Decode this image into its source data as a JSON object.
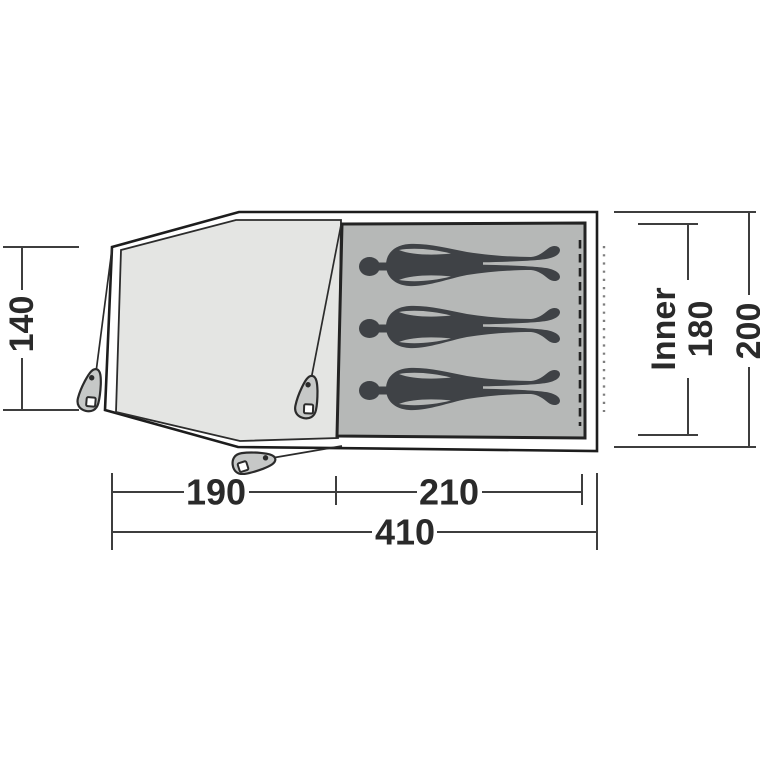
{
  "diagram": {
    "title": "tent-floorplan-top-view",
    "dimensions": {
      "porch_depth": "140",
      "porch_width": "190",
      "inner_length": "210",
      "total_width": "410",
      "inner_label": "Inner",
      "inner_width": "180",
      "total_depth": "200"
    },
    "occupants": {
      "count": 3,
      "icon": "sleeping-person-silhouette"
    },
    "colors": {
      "background": "#ffffff",
      "outline": "#1d1d1d",
      "porch_fill": "#e4e5e3",
      "inner_fill": "#b6b8b7",
      "figure_fill": "#3f4246",
      "peg_fill": "#c6c8c7",
      "dotted_line": "#7e7e7e",
      "dimension_line": "#3e3e3e",
      "label_text": "#2a2a2a"
    }
  }
}
